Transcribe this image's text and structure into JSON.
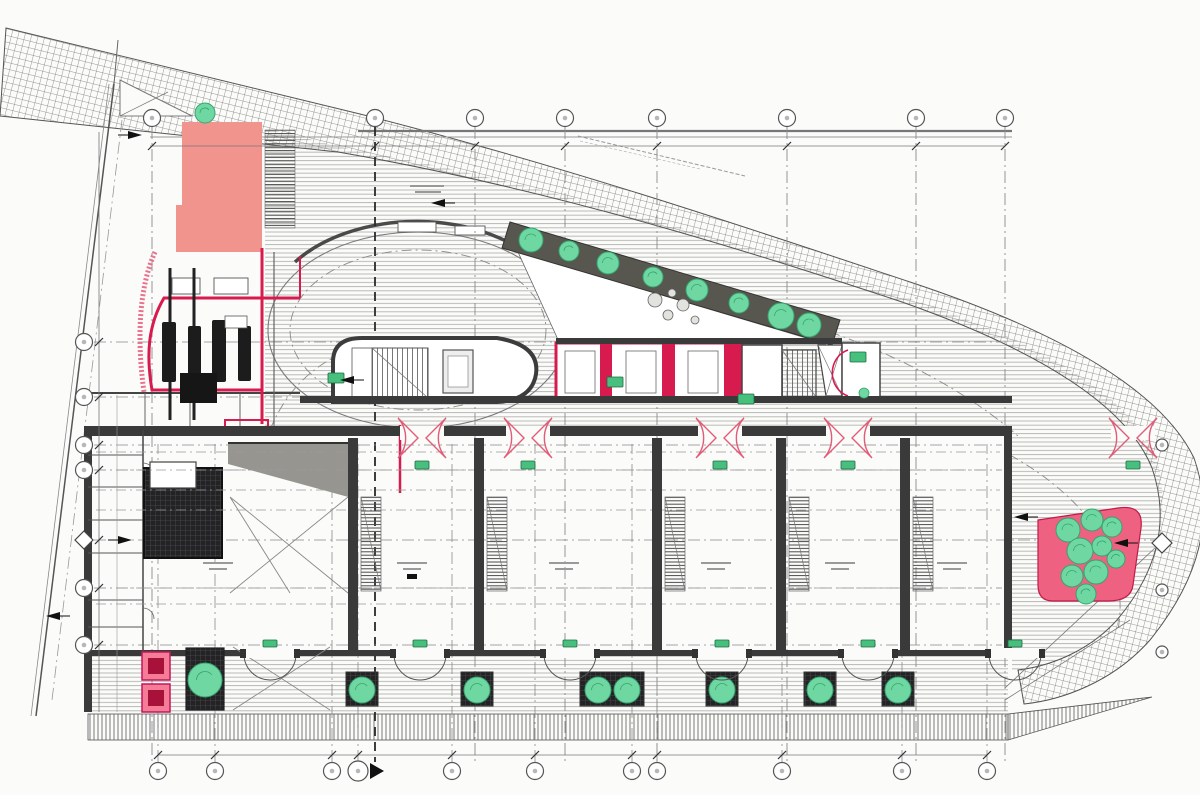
{
  "canvas": {
    "width": 1200,
    "height": 795,
    "background": "#fbfbfa"
  },
  "palette": {
    "line": "#444444",
    "wall": "#3a3a3a",
    "stripe": "#b9b9b6",
    "hatch": "#76766f",
    "red": "#d81b4f",
    "red_soft": "#e05c77",
    "pink_light": "#f2948e",
    "pink_bright": "#ee6180",
    "pink_box": "#f47c96",
    "pink_box_inner": "#a8123a",
    "green": "#6fd8a2",
    "green_dark": "#35a56f",
    "badge_green": "#46c07c",
    "strip_dark": "#57564f",
    "ramp_gray": "#97958f",
    "dash_gray": "#8a8a8a"
  },
  "grid": {
    "top": {
      "y": 118,
      "xs": [
        152,
        375,
        475,
        565,
        657,
        787,
        916,
        1005
      ],
      "heavy_x": 375
    },
    "bottom": {
      "y": 771,
      "xs": [
        158,
        215,
        332,
        358,
        452,
        535,
        632,
        657,
        782,
        902,
        987
      ],
      "pointer_x": 358
    },
    "left": {
      "x": 84,
      "ys": [
        342,
        397,
        445,
        470,
        588,
        645
      ],
      "diamond_y": 540
    },
    "right": {
      "x": 1162,
      "ys": [
        445,
        590,
        652
      ],
      "diamond_y": 543
    }
  },
  "bays": {
    "piers_x": [
      348,
      474,
      652,
      776,
      900
    ],
    "stair_hatch": {
      "dx": 13,
      "y": 497,
      "w": 20,
      "h": 94
    },
    "label_xs": [
      218,
      412,
      564,
      716,
      840,
      952
    ],
    "label_y": 562,
    "dash_ys": [
      452,
      470,
      490,
      510,
      588,
      604
    ]
  },
  "doors": {
    "top_red_xs": [
      422,
      528,
      720,
      848,
      1133
    ],
    "top_red_y": 438,
    "bottom_xs": [
      270,
      420,
      570,
      722,
      868,
      1015
    ],
    "bottom_y": 654
  },
  "trees": {
    "strip": [
      [
        531,
        240,
        12
      ],
      [
        569,
        251,
        10
      ],
      [
        608,
        263,
        11
      ],
      [
        653,
        277,
        10
      ],
      [
        697,
        290,
        11
      ],
      [
        739,
        303,
        10
      ],
      [
        781,
        316,
        13
      ],
      [
        809,
        325,
        12
      ]
    ],
    "walkway": {
      "trees_x": [
        362,
        477,
        598,
        627,
        722,
        820,
        898
      ],
      "cy": 690,
      "r": 13,
      "planters": [
        [
          346,
          32
        ],
        [
          461,
          32
        ],
        [
          580,
          64
        ],
        [
          706,
          32
        ],
        [
          804,
          32
        ],
        [
          882,
          32
        ]
      ],
      "planter_y": 672,
      "planter_h": 34
    },
    "singles": [
      [
        205,
        113,
        10
      ],
      [
        205,
        680,
        17
      ]
    ]
  },
  "right_planter": {
    "blobs": [
      [
        1068,
        530,
        12
      ],
      [
        1092,
        520,
        11
      ],
      [
        1112,
        527,
        10
      ],
      [
        1080,
        551,
        13
      ],
      [
        1102,
        546,
        10
      ],
      [
        1072,
        576,
        11
      ],
      [
        1096,
        572,
        12
      ],
      [
        1116,
        559,
        9
      ],
      [
        1086,
        594,
        10
      ]
    ]
  },
  "badges": [
    [
      336,
      378
    ],
    [
      615,
      382
    ],
    [
      746,
      399
    ],
    [
      858,
      357
    ]
  ],
  "green_dots": [
    [
      864,
      393,
      5
    ]
  ],
  "arrows": [
    [
      128,
      135,
      1
    ],
    [
      445,
      203,
      -1
    ],
    [
      118,
      540,
      1
    ],
    [
      60,
      616,
      -1
    ],
    [
      1128,
      543,
      -1
    ],
    [
      1028,
      517,
      -1
    ],
    [
      354,
      380,
      -1
    ]
  ]
}
